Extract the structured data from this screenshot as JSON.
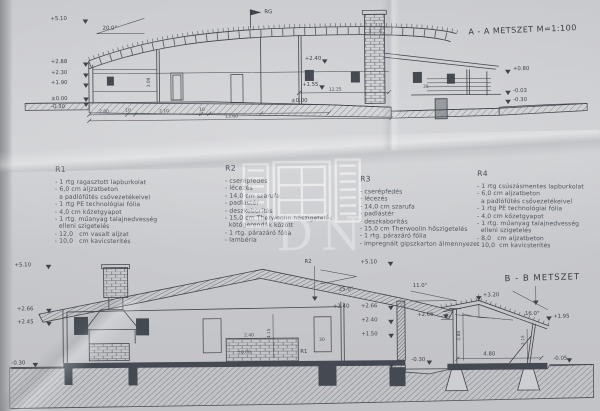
{
  "colors": {
    "paper": "#c9cacd",
    "ink": "#3f434b",
    "dark_fill": "#454a52",
    "hatch": "#74777e",
    "watermark": "#ffffff"
  },
  "aa": {
    "title": "A - A  METSZET   M=1:100",
    "flag_label": "RG",
    "roof_angle": "20.0°",
    "elev_left": [
      "+5.10",
      "+2.88",
      "+2.30",
      "+1.90",
      "±0.00",
      "-0.30"
    ],
    "elev_mid": [
      "+2.40",
      "+1.55",
      "±0.00"
    ],
    "elev_right": [
      "+0.80",
      "-0.03",
      "-0.30"
    ],
    "dims": [
      "2.00",
      "10",
      "2.10",
      "10",
      "13.60",
      "12.25",
      "3.09",
      "30"
    ]
  },
  "legend": {
    "r1": {
      "title": "R1",
      "items": [
        "- 1 rtg ragasztott lapburkolat",
        "- 6,0 cm aljzatbeton",
        "  a padlófűtés csővezetékeivel",
        "- 1 rtg PE technológiai fólia",
        "- 4,0 cm kőzetgyapot",
        "- 1 rtg. műanyag talajnedvesség",
        "  elleni szigetelés",
        "- 12,0   cm vasalt aljzat",
        "- 10,0   cm kavicsterítés"
      ]
    },
    "r2": {
      "title": "R2",
      "items": [
        "- cserépfedés",
        "- lécezés",
        "- 14,0 cm szarufa",
        "- padlástér",
        "- deszkaborítás",
        "- 15,0 cm Therwoolin hőszigetelés",
        "  kötőgerendák között",
        "- 1 rtg. párazáró fólia",
        "- lambéria"
      ]
    },
    "r3": {
      "title": "R3",
      "items": [
        "- cserépfedés",
        "- lécezés",
        "- 14,0 cm szarufa",
        "- padlástér",
        "- deszkaborítás",
        "- 15,0 cm Therwoolin hőszigetelés",
        "- 1 rtg. párazáró fólia",
        "- impregnált gipszkarton álmennyezet"
      ]
    },
    "r4": {
      "title": "R4",
      "items": [
        "- 1 rtg csúszásmentes lapburkolat",
        "- 6,0 cm aljzatbeton",
        "  a padlófűtés csővezetékeivel",
        "- 1 rtg PE technológiai fólia",
        "- 4,0 cm kőzetgyapot",
        "- 1 rtg. műanyag talajnedvesség",
        "  elleni szigetelés",
        "- 8,0   cm aljzatbeton",
        "- 10,0  cm kavicsterítés"
      ]
    }
  },
  "cc": {
    "labels_left": [
      "+5.10",
      "+2.66",
      "+2.45",
      "-0.30"
    ],
    "labels_right": [
      "+5.10",
      "+2.66",
      "+2.40",
      "+1.50",
      "-0.50"
    ],
    "roof_ref": "R2",
    "floor_ref": "R1",
    "roof_angle": "25.0°",
    "inner": [
      "+2.40",
      "2.40",
      "±0.00",
      "4.15",
      "30"
    ]
  },
  "bb": {
    "title": "B - B  METSZET",
    "ridge": "+3.20",
    "angle_left": "11.0°",
    "angle_right": "16.0°",
    "elev_left": "+2.66",
    "elev_right": "+1.95",
    "height_left": "2.80",
    "height_right": "2.15",
    "width": "4.80",
    "ground_left": "-0.30",
    "ground_right": "-0.05"
  },
  "watermark": {
    "letters": "DN"
  }
}
